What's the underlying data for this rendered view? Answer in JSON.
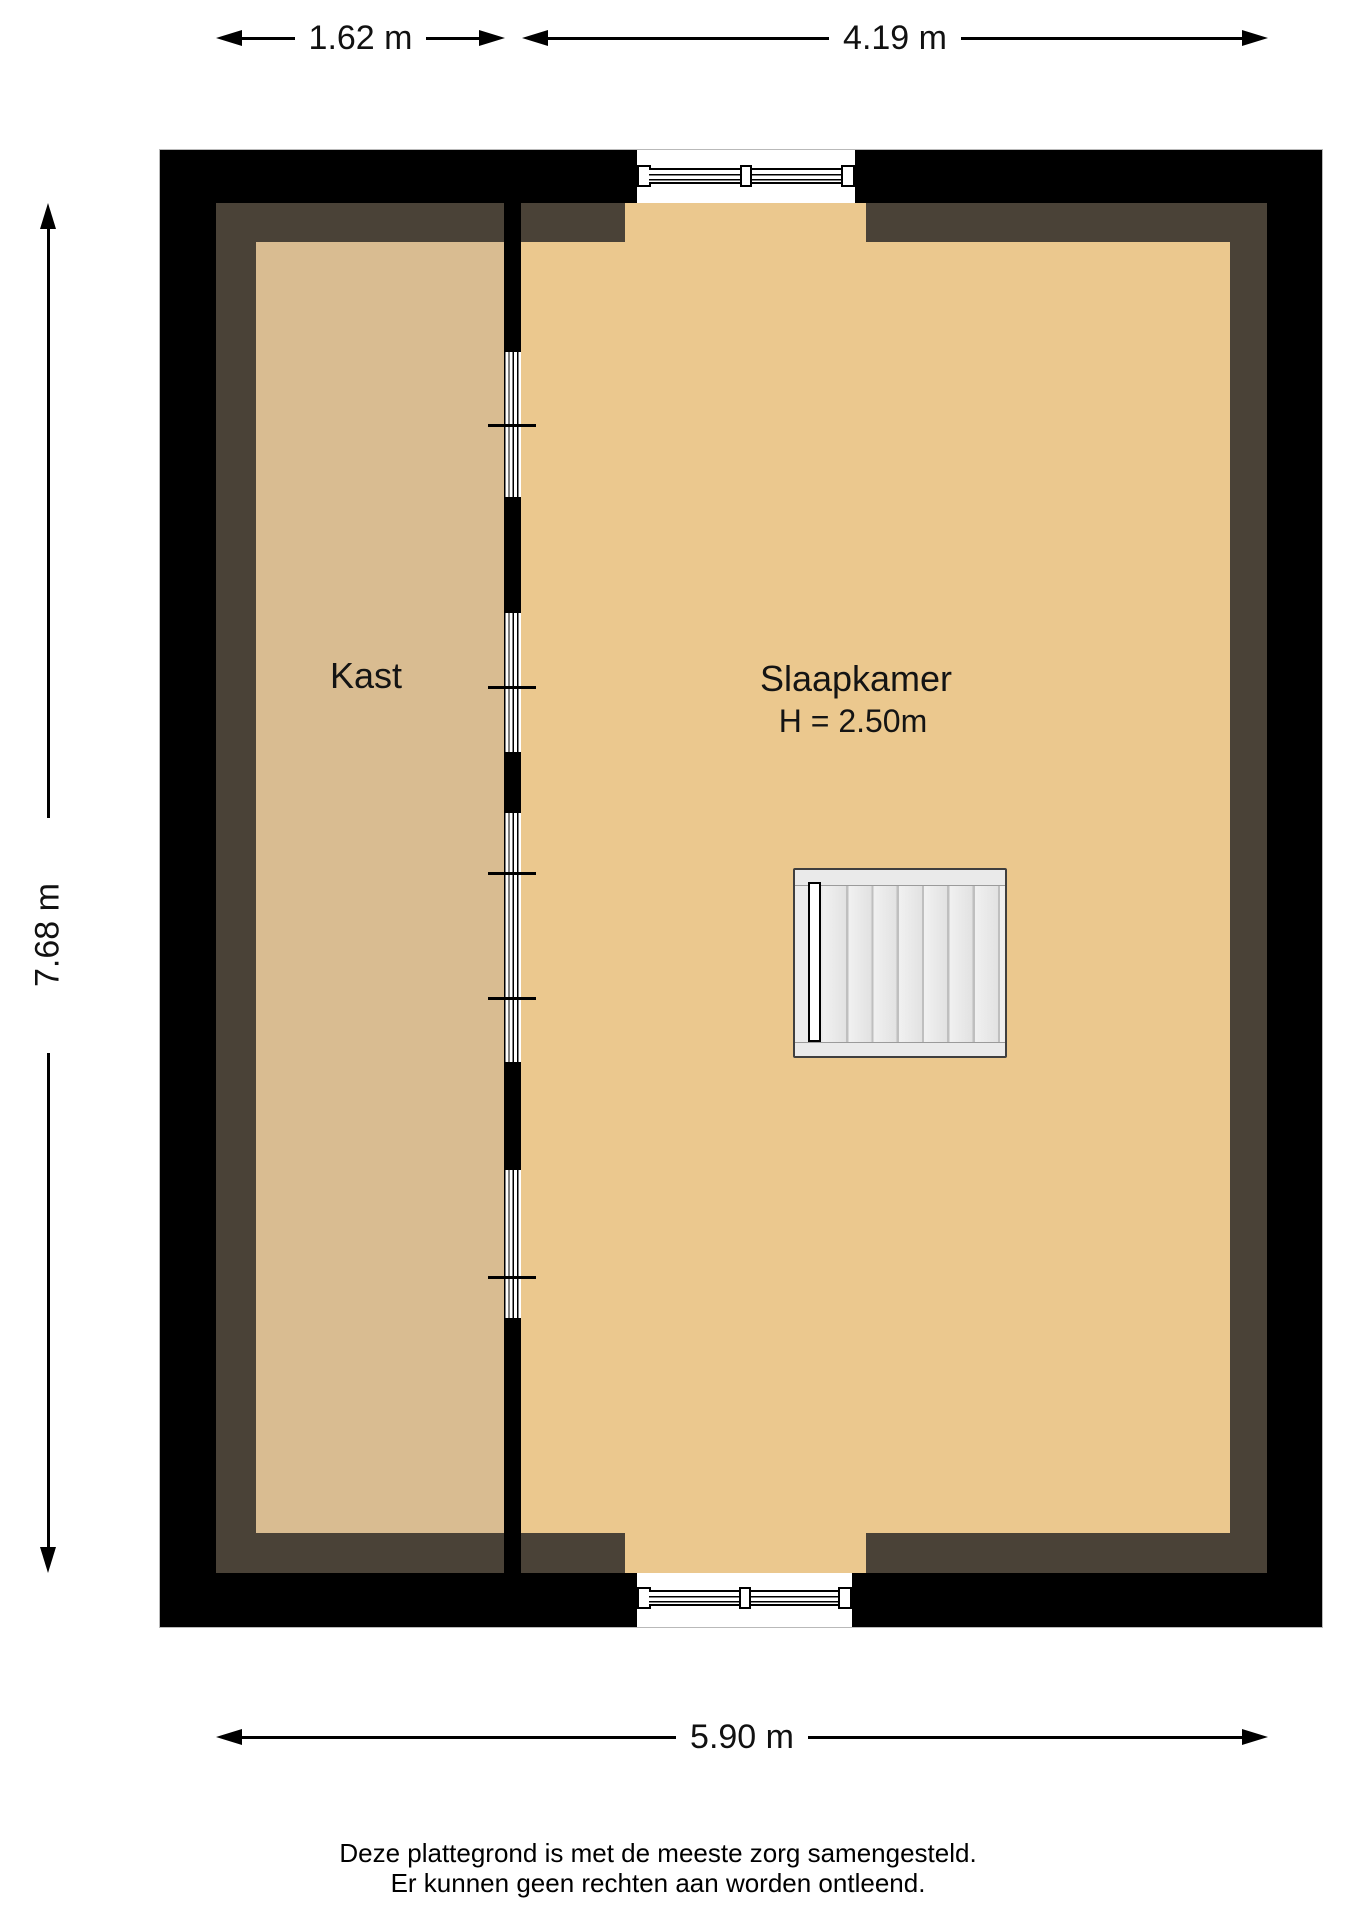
{
  "floorplan": {
    "dimensions": {
      "kast_width": "1.62 m",
      "slaapkamer_width": "4.19 m",
      "total_height": "7.68 m",
      "total_width": "5.90 m"
    },
    "rooms": {
      "kast": {
        "label": "Kast"
      },
      "slaapkamer": {
        "label": "Slaapkamer",
        "ceiling_height": "H = 2.50m"
      }
    },
    "disclaimer": {
      "line1": "Deze plattegrond is met de meeste zorg samengesteld.",
      "line2": "Er kunnen geen rechten aan worden ontleend."
    },
    "colors": {
      "wall": "#000000",
      "floor_shadow": "#4a4237",
      "kast_floor": "#d9bc91",
      "slaapkamer_floor": "#ebc88e",
      "stairs_fill": "#ececec",
      "stairs_border": "#3f3f3f"
    }
  }
}
